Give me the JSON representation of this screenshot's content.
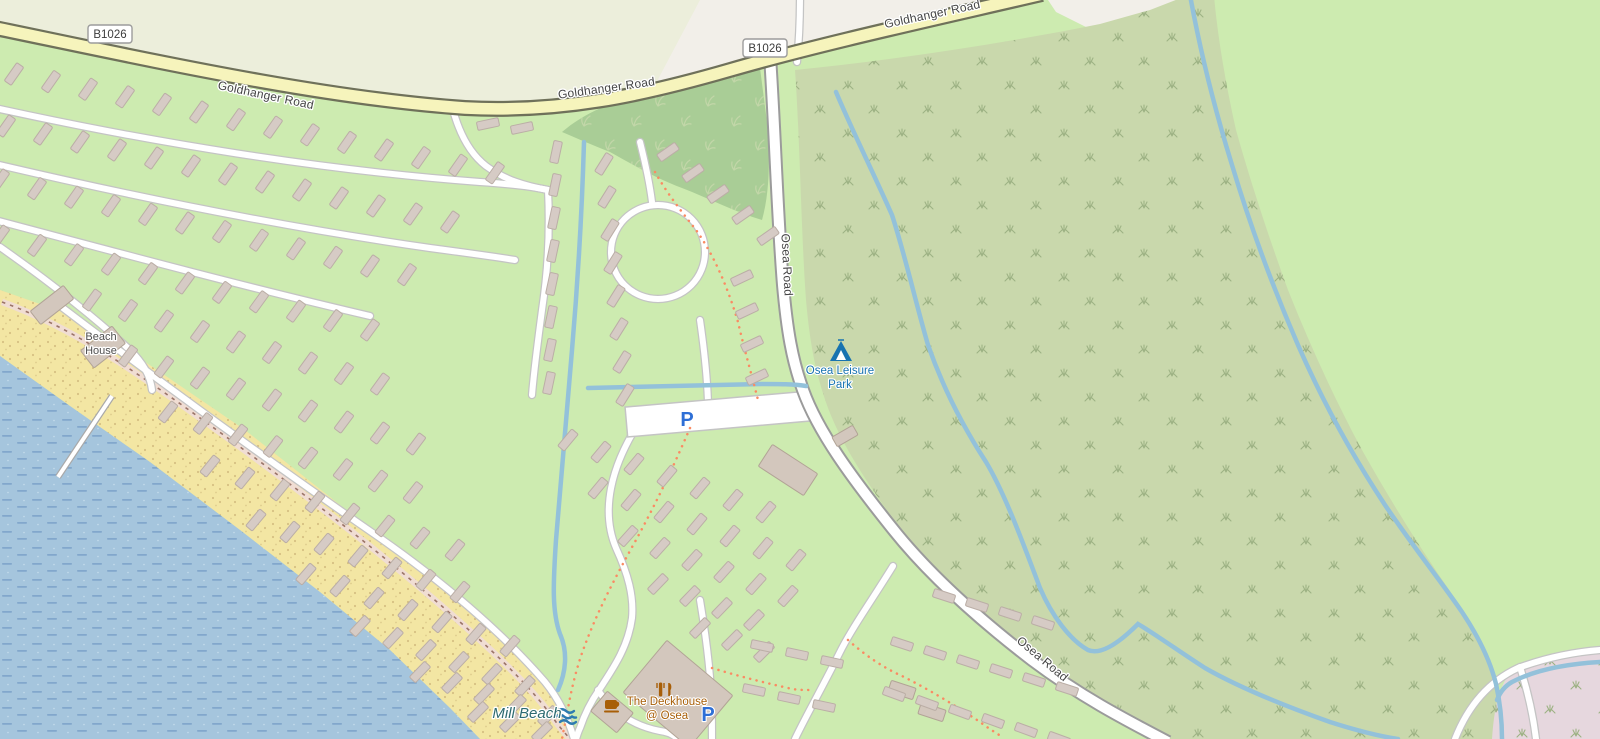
{
  "map": {
    "road_names": {
      "b1026": "B1026",
      "goldhanger": "Goldhanger Road",
      "osea": "Osea Road"
    },
    "labels": {
      "beach_house": {
        "line1": "Beach",
        "line2": "House"
      },
      "osea_leisure_park": {
        "line1": "Osea Leisure",
        "line2": "Park"
      },
      "mill_beach": "Mill Beach",
      "deckhouse": {
        "line1": "The Deckhouse",
        "line2": "@ Osea"
      },
      "parking_symbol": "P"
    },
    "icons": {
      "campsite": "tent-icon",
      "restaurant": "fork-and-knife-icon",
      "cafe": "coffee-cup-icon",
      "beach": "waves-icon",
      "parking": "letter-P-marker"
    },
    "caravan_rows": [
      {
        "x": 14,
        "y": 74,
        "dx": 37,
        "dy": 7.6,
        "n": 14,
        "a": -55
      },
      {
        "x": 6,
        "y": 126,
        "dx": 37,
        "dy": 8,
        "n": 13,
        "a": -55
      },
      {
        "x": 0,
        "y": 180,
        "dx": 37,
        "dy": 8.6,
        "n": 12,
        "a": -55
      },
      {
        "x": 0,
        "y": 236,
        "dx": 37,
        "dy": 9.4,
        "n": 11,
        "a": -54
      },
      {
        "x": 92,
        "y": 300,
        "dx": 36,
        "dy": 10.5,
        "n": 9,
        "a": -54
      },
      {
        "x": 128,
        "y": 356,
        "dx": 36,
        "dy": 11,
        "n": 9,
        "a": -53
      },
      {
        "x": 168,
        "y": 412,
        "dx": 35,
        "dy": 11.5,
        "n": 8,
        "a": -52
      },
      {
        "x": 210,
        "y": 466,
        "dx": 35,
        "dy": 12,
        "n": 8,
        "a": -51
      },
      {
        "x": 256,
        "y": 520,
        "dx": 34,
        "dy": 12,
        "n": 7,
        "a": -50
      },
      {
        "x": 306,
        "y": 574,
        "dx": 34,
        "dy": 12,
        "n": 7,
        "a": -49
      },
      {
        "x": 360,
        "y": 626,
        "dx": 33,
        "dy": 12,
        "n": 6,
        "a": -47
      },
      {
        "x": 420,
        "y": 672,
        "dx": 32,
        "dy": 11,
        "n": 5,
        "a": -46
      },
      {
        "x": 478,
        "y": 712,
        "dx": 32,
        "dy": 10,
        "n": 3,
        "a": -45
      },
      {
        "x": 488,
        "y": 124,
        "dx": 34,
        "dy": 4,
        "n": 2,
        "a": -12
      },
      {
        "x": 556,
        "y": 152,
        "dx": -1,
        "dy": 33,
        "n": 8,
        "a": -78
      },
      {
        "x": 604,
        "y": 164,
        "dx": 3,
        "dy": 33,
        "n": 8,
        "a": -58
      },
      {
        "x": 668,
        "y": 152,
        "dx": 25,
        "dy": 21,
        "n": 5,
        "a": -35
      },
      {
        "x": 742,
        "y": 278,
        "dx": 5,
        "dy": 33,
        "n": 4,
        "a": -25
      },
      {
        "x": 568,
        "y": 440,
        "dx": 33,
        "dy": 12,
        "n": 7,
        "a": -50
      },
      {
        "x": 598,
        "y": 488,
        "dx": 33,
        "dy": 12,
        "n": 7,
        "a": -50
      },
      {
        "x": 628,
        "y": 536,
        "dx": 32,
        "dy": 12,
        "n": 6,
        "a": -48
      },
      {
        "x": 658,
        "y": 584,
        "dx": 32,
        "dy": 12,
        "n": 4,
        "a": -46
      },
      {
        "x": 700,
        "y": 628,
        "dx": 32,
        "dy": 12,
        "n": 3,
        "a": -45
      },
      {
        "x": 762,
        "y": 646,
        "dx": 35,
        "dy": 8,
        "n": 3,
        "a": 12
      },
      {
        "x": 754,
        "y": 690,
        "dx": 35,
        "dy": 8,
        "n": 3,
        "a": 12
      },
      {
        "x": 944,
        "y": 596,
        "dx": 33,
        "dy": 9,
        "n": 4,
        "a": 18
      },
      {
        "x": 902,
        "y": 644,
        "dx": 33,
        "dy": 9,
        "n": 6,
        "a": 18
      },
      {
        "x": 894,
        "y": 694,
        "dx": 33,
        "dy": 9,
        "n": 6,
        "a": 20
      }
    ],
    "buildings": [
      {
        "x": 52,
        "y": 305,
        "w": 42,
        "h": 17,
        "a": -38
      },
      {
        "x": 103,
        "y": 347,
        "w": 40,
        "h": 22,
        "a": -38
      },
      {
        "x": 788,
        "y": 470,
        "w": 54,
        "h": 26,
        "a": 33
      },
      {
        "x": 845,
        "y": 436,
        "w": 24,
        "h": 11,
        "a": -30
      },
      {
        "x": 678,
        "y": 694,
        "w": 86,
        "h": 68,
        "a": 40
      },
      {
        "x": 612,
        "y": 712,
        "w": 34,
        "h": 26,
        "a": 40
      },
      {
        "x": 902,
        "y": 690,
        "w": 26,
        "h": 12,
        "a": 18
      },
      {
        "x": 932,
        "y": 712,
        "w": 26,
        "h": 12,
        "a": 18
      }
    ]
  },
  "colors": {
    "base": "#f2efe9",
    "farmland": "#eceedb",
    "green": "#cdebb0",
    "forest": "#a9cd96",
    "scrub": "#c9d8ac",
    "scrubSym": "#9db284",
    "treeSym": "#c2d6a8",
    "water": "#a5c5dd",
    "waterDash": "#82a7cc",
    "stream": "#93c1da",
    "beach": "#f3e6a3",
    "beachDot": "#d6c183",
    "roadYellowFill": "#f6f4bc",
    "roadYellowCasing": "#6f715a",
    "roadWhiteCasing": "#c4c4c4",
    "oseaCasing": "#9b9b9b",
    "building": "#d3c7bd",
    "buildingStroke": "#b2a496",
    "caravan": "#d6cbc5",
    "caravanStroke": "#bbaea6",
    "pink": "#e6d7de",
    "path": "#fa8b63",
    "shorePath": "#f0ddd3",
    "shorePathDash": "#9b7468",
    "textRoad": "#454545",
    "textBeachHouse": "#4e4e4e",
    "poiBlue": "#1873b0",
    "parkingBlue": "#2e6fd6",
    "beachLabel": "#2d6a70",
    "amber": "#a85f08",
    "badgeText": "#3c3c3c",
    "badgeBorder": "#9c9c9c"
  }
}
